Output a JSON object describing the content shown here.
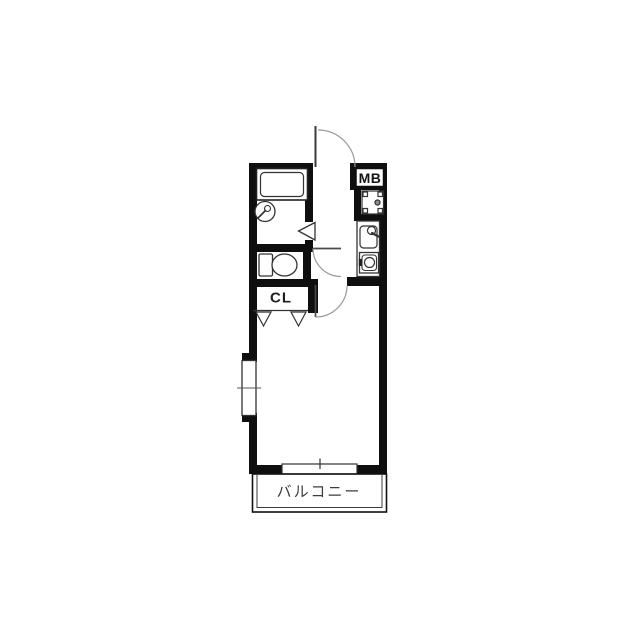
{
  "floorplan": {
    "type": "apartment-1K-floor-plan",
    "labels": {
      "meter_box": "MB",
      "closet": "CL",
      "balcony": "バルコニー"
    },
    "colors": {
      "background": "#ffffff",
      "wall": "#0f0f0f",
      "fixture_line": "#333333",
      "door_arc": "#9a9a9a",
      "label_text": "#3c3c3c"
    },
    "fixtures": [
      "entrance-door-swing",
      "meter-box",
      "washing-machine-pan",
      "kitchen-sink",
      "single-burner-stove",
      "bathtub",
      "round-washbasin",
      "bathroom-folding-door",
      "toilet",
      "toilet-door-swing",
      "main-room-door-swing",
      "closet-bifold-doors",
      "left-wall-window",
      "balcony-sliding-window",
      "balcony"
    ]
  }
}
